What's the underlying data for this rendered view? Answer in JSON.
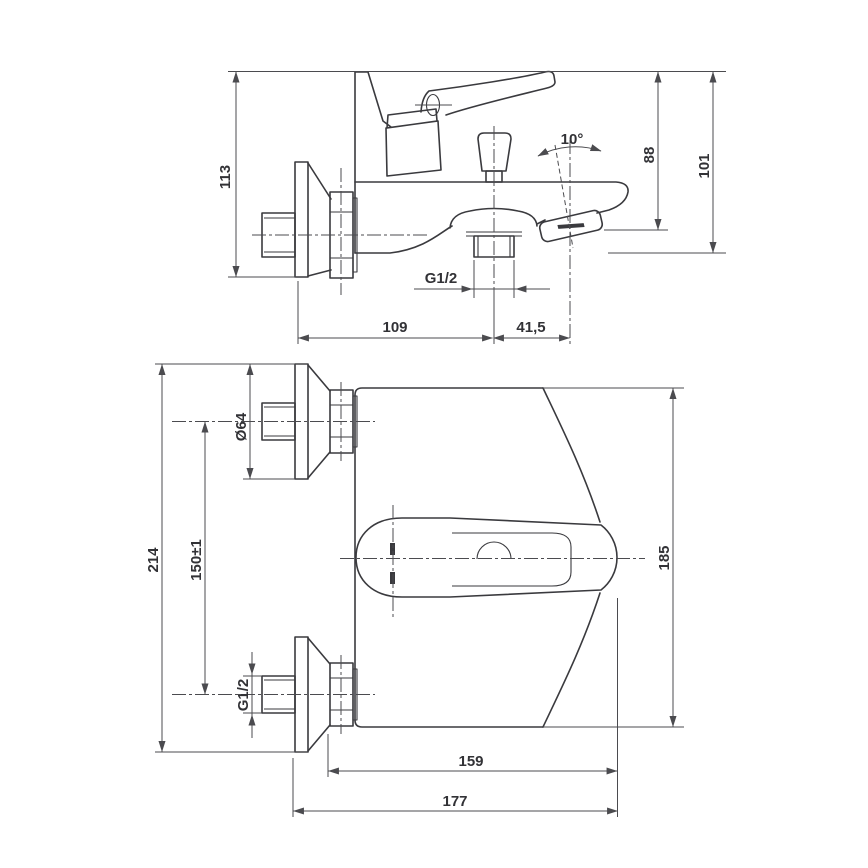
{
  "drawing_type": "technical-dimension-drawing",
  "subject": "wall-mounted bath mixer tap, two orthographic views",
  "colors": {
    "background": "#ffffff",
    "line": "#3a3a3e",
    "dimension_line": "#4b4b4f",
    "text": "#323236"
  },
  "side_view": {
    "wall_plate_height": "113",
    "spout_angle": "10°",
    "top_to_shower_outlet_height": "88",
    "overall_height": "101",
    "spout_outlet_thread": "G1/2",
    "spout_reach": "109",
    "shower_outlet_offset": "41,5"
  },
  "front_view": {
    "overall_width": "214",
    "flange_diameter": "Ø64",
    "inlet_spacing": "150±1",
    "inlet_thread": "G1/2",
    "body_width": "185",
    "body_depth": "159",
    "overall_depth": "177"
  }
}
